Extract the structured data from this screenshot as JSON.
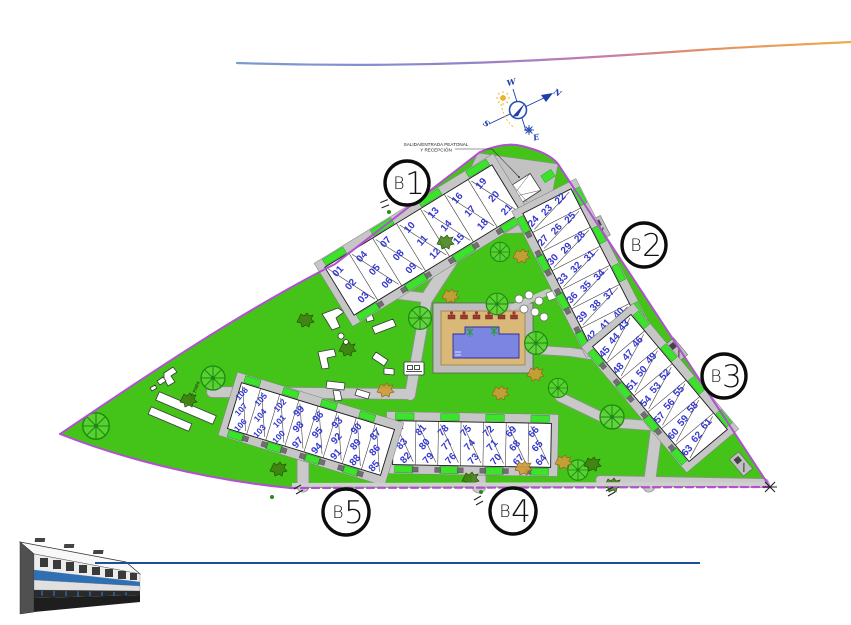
{
  "compass": {
    "north": "N",
    "south": "S",
    "east": "E",
    "west": "W"
  },
  "labels": {
    "entrance_line1": "SALIDA/ENTRADA PEATONAL",
    "entrance_line2": "Y RECEPCIÓN",
    "pet_park": "PET PARK"
  },
  "blocks": [
    {
      "id": "b1",
      "name": "B1",
      "prefix": "B",
      "number": "1",
      "units": [
        [
          "01",
          "02",
          "03"
        ],
        [
          "04",
          "05",
          "06"
        ],
        [
          "07",
          "08",
          "09"
        ],
        [
          "10",
          "11",
          "12"
        ],
        [
          "13",
          "14",
          "15"
        ],
        [
          "16",
          "17",
          "18"
        ],
        [
          "19",
          "20",
          "21"
        ]
      ]
    },
    {
      "id": "b2",
      "name": "B2",
      "prefix": "B",
      "number": "2",
      "units": [
        [
          "22",
          "23",
          "24"
        ],
        [
          "25",
          "26",
          "27"
        ],
        [
          "28",
          "29",
          "30"
        ],
        [
          "31",
          "32",
          "33"
        ],
        [
          "34",
          "35",
          "36"
        ],
        [
          "37",
          "38",
          "39"
        ],
        [
          "40",
          "41",
          "42"
        ]
      ]
    },
    {
      "id": "b3",
      "name": "B3",
      "prefix": "B",
      "number": "3",
      "units": [
        [
          "43",
          "44",
          "45"
        ],
        [
          "46",
          "47",
          "48"
        ],
        [
          "49",
          "50",
          "51"
        ],
        [
          "52",
          "53",
          "54"
        ],
        [
          "55",
          "56",
          "57"
        ],
        [
          "58",
          "59",
          "60"
        ],
        [
          "61",
          "62",
          "63"
        ]
      ]
    },
    {
      "id": "b4",
      "name": "B4",
      "prefix": "B",
      "number": "4",
      "units": [
        [
          "84",
          "83",
          "82"
        ],
        [
          "81",
          "80",
          "79"
        ],
        [
          "78",
          "77",
          "76"
        ],
        [
          "75",
          "74",
          "73"
        ],
        [
          "72",
          "71",
          "70"
        ],
        [
          "69",
          "68",
          "67"
        ],
        [
          "66",
          "65",
          "64"
        ]
      ]
    },
    {
      "id": "b5",
      "name": "B5",
      "prefix": "B",
      "number": "5",
      "units": [
        [
          "108",
          "107",
          "106"
        ],
        [
          "105",
          "104",
          "103"
        ],
        [
          "102",
          "101",
          "100"
        ],
        [
          "99",
          "98",
          "97"
        ],
        [
          "96",
          "95",
          "94"
        ],
        [
          "93",
          "92",
          "91"
        ],
        [
          "90",
          "89",
          "88"
        ],
        [
          "87",
          "86",
          "85"
        ]
      ]
    }
  ],
  "colors": {
    "lawn": "#44c418",
    "hedge": "#3be32a",
    "tree": "#1c8a12",
    "road": "#c9c9c9",
    "boundary": "#b34fd2",
    "unit_number": "#3538cf",
    "pool_water": "#7c86e2",
    "pool_deck": "#d9b878",
    "bottom_line": "#1a4f9c",
    "compass_blue": "#1d3faa",
    "swoosh": [
      "#7a9ad0",
      "#8d85cc",
      "#c27bb0",
      "#e49360",
      "#ecad4e"
    ]
  }
}
